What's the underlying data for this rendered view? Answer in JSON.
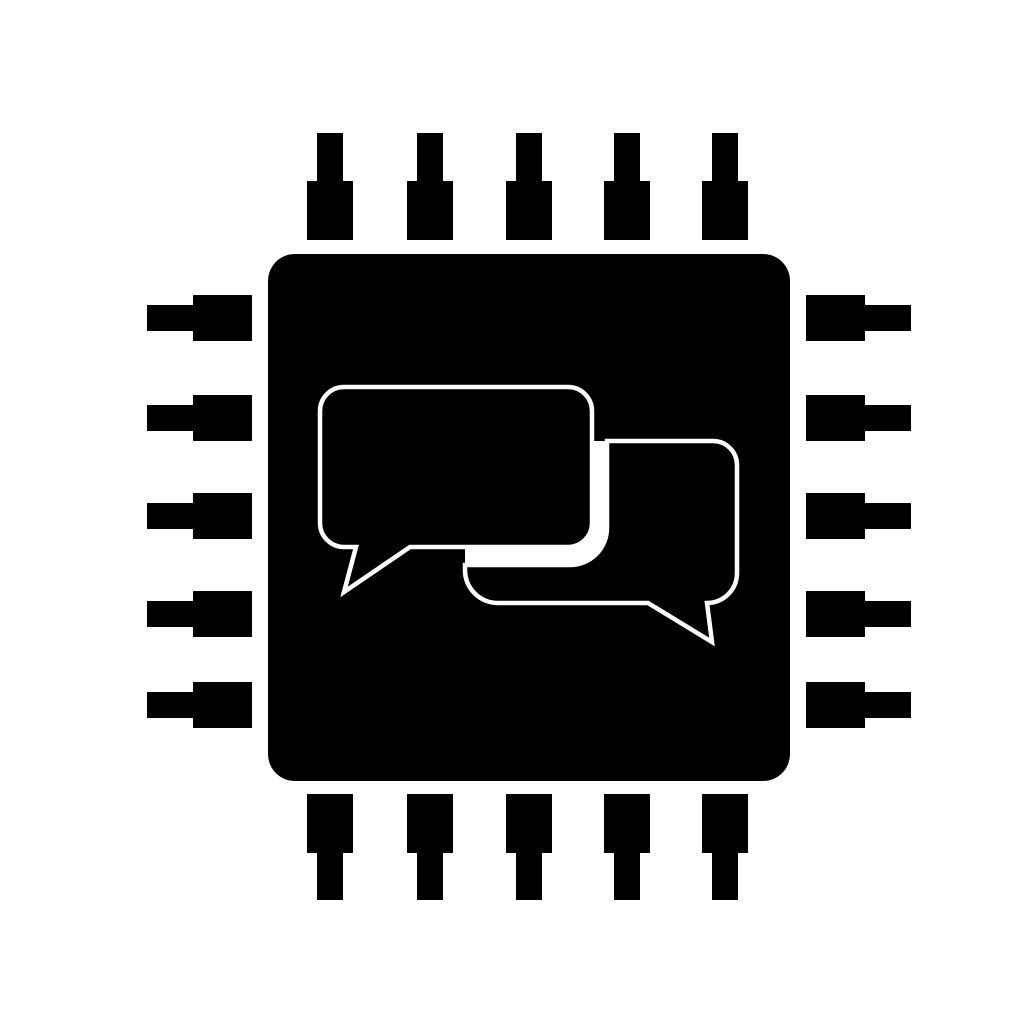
{
  "canvas": {
    "width": 1024,
    "height": 1024,
    "background": "#ffffff"
  },
  "icon": {
    "name": "cpu-chip-with-chat-bubbles",
    "fill_color": "#000000",
    "cutout_color": "#ffffff",
    "chip": {
      "x": 268,
      "y": 254,
      "width": 522,
      "height": 527,
      "corner_radius": 27
    },
    "pins": {
      "top": {
        "centers": [
          330,
          430,
          529,
          627,
          725
        ],
        "narrow": {
          "from": 133,
          "to": 181,
          "across": 26
        },
        "wide": {
          "from": 181,
          "to": 240,
          "across": 46
        }
      },
      "bottom": {
        "centers": [
          330,
          430,
          529,
          627,
          725
        ],
        "narrow": {
          "from": 853,
          "to": 900,
          "across": 26
        },
        "wide": {
          "from": 794,
          "to": 853,
          "across": 46
        }
      },
      "left": {
        "centers": [
          318,
          418,
          516,
          614,
          705
        ],
        "narrow": {
          "from": 147,
          "to": 193,
          "across": 26
        },
        "wide": {
          "from": 193,
          "to": 252,
          "across": 46
        }
      },
      "right": {
        "centers": [
          318,
          418,
          516,
          614,
          705
        ],
        "narrow": {
          "from": 865,
          "to": 911,
          "across": 26
        },
        "wide": {
          "from": 806,
          "to": 865,
          "across": 46
        }
      }
    },
    "bubbles": {
      "overlap_channel": {
        "path": "M607,441 L607,528 A37,37 0 0 1 570,565 L465,565 L465,547 L568,547 A24,24 0 0 0 592,523 L592,441 Z"
      },
      "large": {
        "path": "M344,387 L568,387 A24,24 0 0 1 592,411 L592,523 A24,24 0 0 1 568,547 L410,547 L344,592 L356,547 L344,547 A24,24 0 0 1 320,523 L320,411 A24,24 0 0 1 344,387 Z",
        "outline_width": 4.5
      },
      "small": {
        "path": "M607,441 L713,441 A24,24 0 0 1 737,465 L737,573 A30,30 0 0 1 707,603 L712,642 L648,603 L498,603 A33,33 0 0 1 465,570 L465,565 L570,565 A37,37 0 0 0 607,528 Z",
        "outline_width": 4.5
      }
    }
  }
}
